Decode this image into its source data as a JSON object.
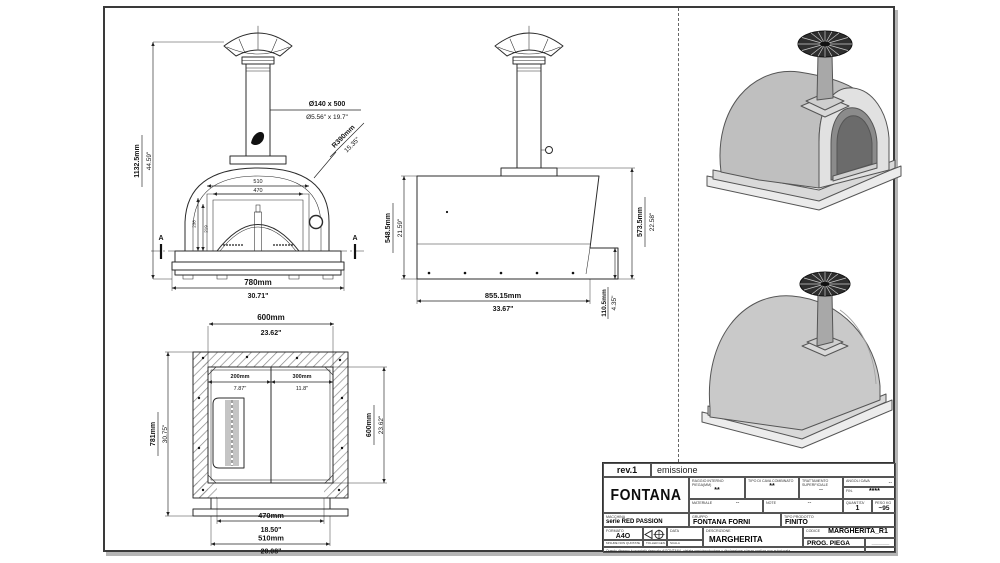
{
  "colors": {
    "line": "#2b2b2b",
    "sheet_border": "#3a3a3a",
    "shadow": "#b5b5b5",
    "iso_body": "#c6c6c6",
    "iso_face": "#e1e1e1",
    "iso_opening": "#6b6b6b",
    "cap_fill": "#2e2e2e"
  },
  "front_view": {
    "overall_height_mm": "1132.5mm",
    "overall_height_in": "44.59\"",
    "chimney_mm": "Ø140 x 500",
    "chimney_in": "Ø5.56\" x 19.7\"",
    "radius_mm": "R390mm",
    "radius_in": "15.35\"",
    "opening_w1": "510",
    "opening_w2": "470",
    "opening_h1": "238",
    "opening_h2": "219",
    "width_mm": "780mm",
    "width_in": "30.71\"",
    "section": "A"
  },
  "side_view": {
    "body_height_mm": "548.5mm",
    "body_height_in": "21.59\"",
    "total_height_mm": "573.5mm",
    "total_height_in": "22.58\"",
    "depth_mm": "855.15mm",
    "depth_in": "33.67\"",
    "step_mm": "110.5mm",
    "step_in": "4.35\""
  },
  "plan_view": {
    "inner_width_mm": "600mm",
    "inner_width_in": "23.62\"",
    "overall_depth_mm": "781mm",
    "overall_depth_in": "30.75\"",
    "left_seg_mm": "200mm",
    "left_seg_in": "7.87\"",
    "right_seg_mm": "300mm",
    "right_seg_in": "11.8\"",
    "inner_depth_mm": "600mm",
    "inner_depth_in": "23.62\"",
    "door_mm": "470mm",
    "door_in": "18.50\"",
    "slab_mm": "510mm",
    "slab_in": "20.08\""
  },
  "title_block": {
    "revision": "rev.1",
    "revision_note": "emissione",
    "logo": "FONTANA",
    "raggio_label": "RAGGIO INTERNO PIEGA(MM)",
    "raggio_value": "**",
    "cava_label": "TIPO DI CAVA COMBINATO",
    "cava_value": "**",
    "trattamento_label": "TRATTAMENTO SUPERFICIALE",
    "trattamento_value": "--",
    "angoli_label": "ANGOLI CAVA",
    "angoli_value": "--",
    "fin_label": "FIN.",
    "fin_value": "****",
    "materiale_label": "MATERIALE",
    "materiale_value": "--",
    "note_label": "NOTE",
    "note_value": "--",
    "quantita_label": "QUANTITA'",
    "quantita_value": "1",
    "peso_label": "PESO Kg",
    "peso_value": "~95",
    "macchina_label": "MACCHINA",
    "macchina_value": "serie RED PASSION",
    "gruppo_label": "GRUPPO",
    "gruppo_value": "FONTANA FORNI",
    "tipo_prodotto_label": "TIPO PRODOTTO",
    "tipo_prodotto_value": "FINITO",
    "formato_label": "FORMATO",
    "formato_value": "A4O",
    "data_label": "DATA",
    "descrizione_label": "DESCRIZIONE",
    "descrizione_value": "MARGHERITA",
    "codice_label": "CODICE",
    "codice_value": "MARGHERITA_R1",
    "prog_label": "PROG. PIEGA",
    "dash_value": "––––––––",
    "misure_label": "MISURE NON QUOTATE",
    "toller_label": "TOLLER.GEN.",
    "scala_label": "SCALA",
    "disclaimer": "Questo disegno è proprietà riservata di FONTANA, vietata ogni riproduzione o divulgazione a terze parti se non autorizzata"
  }
}
